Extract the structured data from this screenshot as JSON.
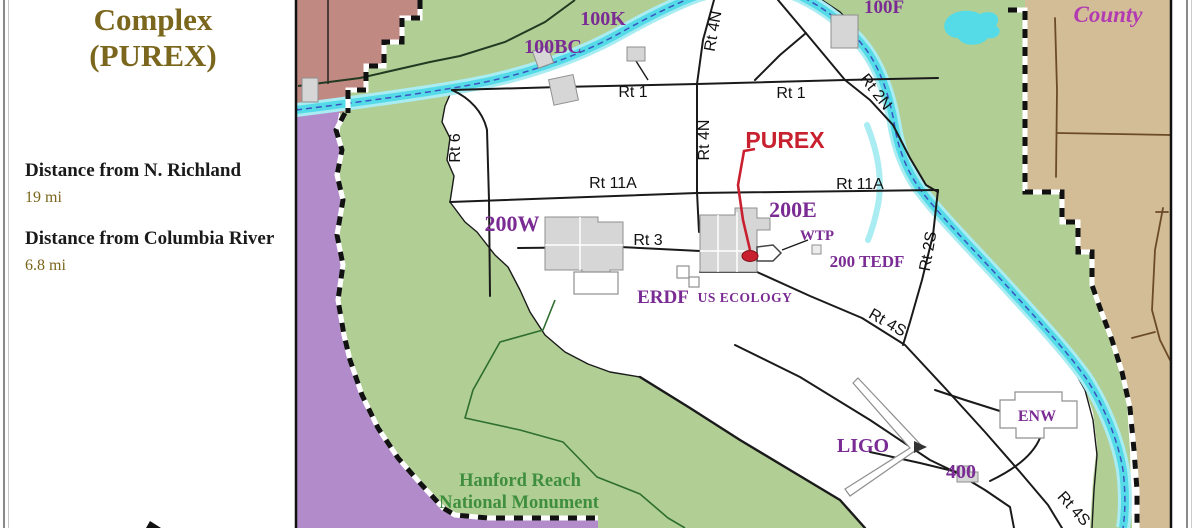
{
  "panel": {
    "title_line1": "Complex",
    "title_line2": "(PUREX)",
    "distance1_label": "Distance from N. Richland",
    "distance1_value": "19 mi",
    "distance2_label": "Distance from Columbia River",
    "distance2_value": "6.8 mi"
  },
  "map": {
    "county_label": "County",
    "purex_label": "PUREX",
    "monument_label_line1": "Hanford Reach",
    "monument_label_line2": "National Monument",
    "areas": {
      "a100k": "100K",
      "a100bc": "100BC",
      "a100f": "100F",
      "a200w": "200W",
      "a200e": "200E",
      "wtp": "WTP",
      "tedf": "200 TEDF",
      "erdf": "ERDF",
      "us_ecology": "US ECOLOGY",
      "ligo": "LIGO",
      "enw": "ENW",
      "a400": "400"
    },
    "routes": {
      "rt1_west": "Rt 1",
      "rt1_east": "Rt 1",
      "rt6": "Rt 6",
      "rt4n_diagonal": "Rt 4N",
      "rt4n_vertical": "Rt 4N",
      "rt2n": "Rt 2N",
      "rt11a_west": "Rt 11A",
      "rt11a_east": "Rt 11A",
      "rt3": "Rt 3",
      "rt2s": "Rt 2S",
      "rt4s_upper": "Rt 4S",
      "rt4s_lower": "Rt 4S"
    }
  },
  "palette": {
    "map-green": "#b1cf95",
    "region-maroon": "#c08a83",
    "region-purple": "#b28bcb",
    "region-tan": "#d3bd96",
    "river-fill": "#54dbe7",
    "river-edge": "#a9ecf2",
    "river-centerline": "#3b55c0",
    "label-purple": "#7b2c94",
    "county-magenta": "#b23ab2",
    "purex-red": "#c8202f",
    "road-black": "#1a1a1a",
    "county-road-brown": "#6b4a28",
    "creek-green": "#2e6e2e",
    "monument-text-green": "#3e8e3e",
    "panel-olive": "#7a661c",
    "building-gray": "#d6d6d6",
    "building-stroke": "#8f8f8f"
  }
}
